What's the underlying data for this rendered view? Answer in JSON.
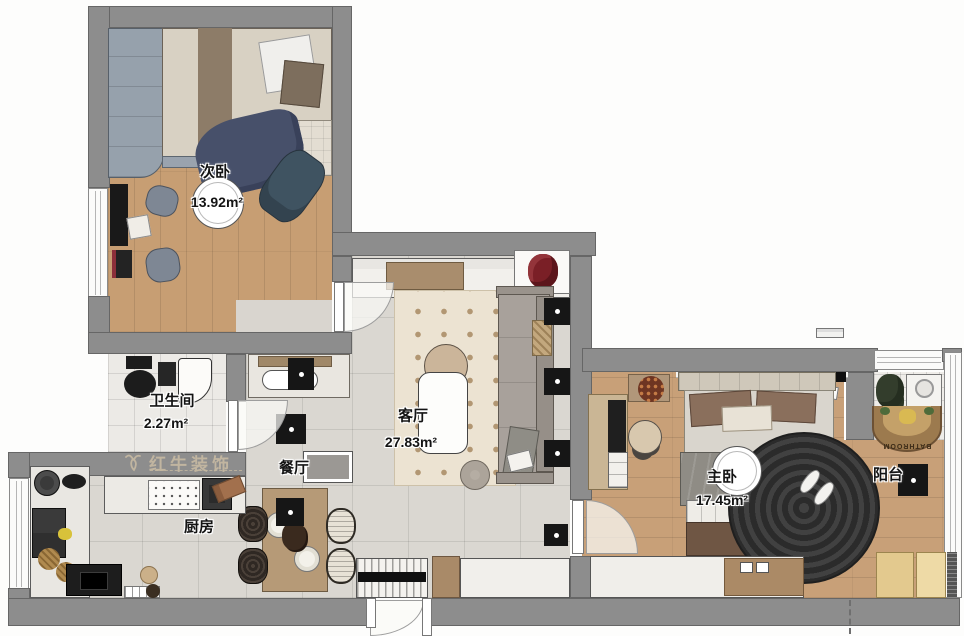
{
  "plan": {
    "title": "apartment floor plan",
    "watermark": {
      "brand": "红牛装饰",
      "logo_icon": "bull-icon"
    },
    "rooms": {
      "secondary_bedroom": {
        "name": "次卧",
        "area": "13.92m²"
      },
      "bathroom": {
        "name": "卫生间",
        "area": "2.27m²"
      },
      "living_room": {
        "name": "客厅",
        "area": "27.83m²"
      },
      "dining_room": {
        "name": "餐厅"
      },
      "kitchen": {
        "name": "厨房"
      },
      "master_bedroom": {
        "name": "主卧",
        "area": "17.45m²"
      },
      "balcony": {
        "name": "阳台"
      }
    },
    "balcony_rug_text": "BATHROOM",
    "colors": {
      "wall": "#8d8d8d",
      "wood_floor": "#c79e73",
      "tile_floor": "#dad7d1",
      "rug": "#ece3d2",
      "rug_dot": "#b29773",
      "accent_black": "#161616",
      "navy_blanket": "#47506a",
      "master_rug": "#2b2b2b",
      "watermark": "#cebfa4"
    }
  }
}
